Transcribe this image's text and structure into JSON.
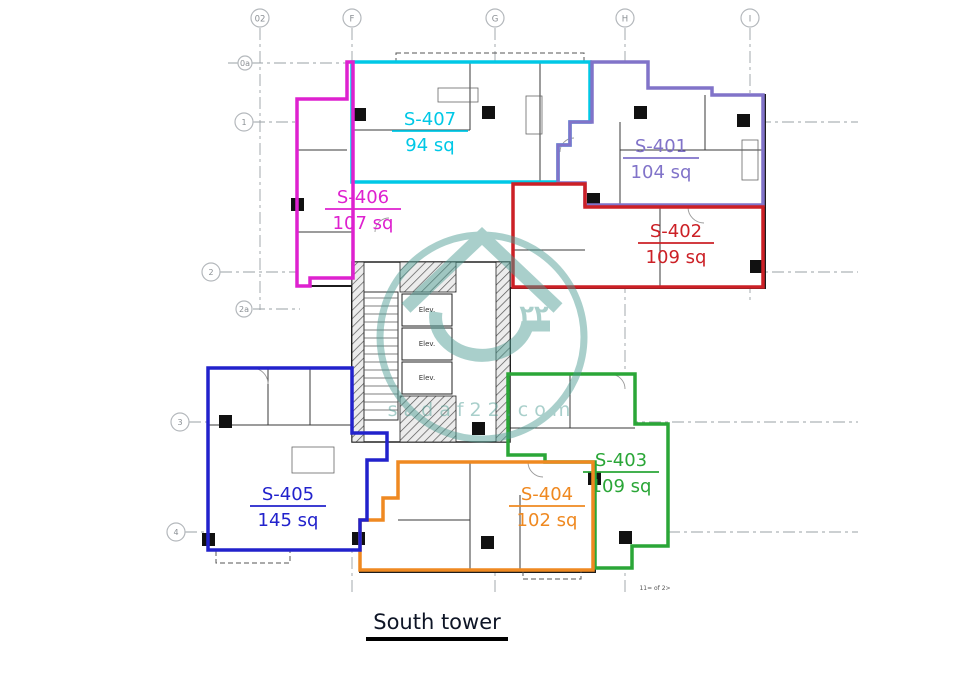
{
  "title": {
    "text": "South tower"
  },
  "footnote": {
    "text": "11= of 2>"
  },
  "watermark": {
    "arabic_number": "٢٢",
    "domain_text": "sadaf22.com",
    "color": "#4d9d93"
  },
  "core": {
    "elevator_label": "Elev."
  },
  "grid": {
    "line_color": "#9aa0a6",
    "bubble_stroke": "#b4b8bc",
    "bubble_text_color": "#8a8f94",
    "top_bubbles": [
      {
        "label": "02",
        "x": 260
      },
      {
        "label": "F",
        "x": 352
      },
      {
        "label": "G",
        "x": 495
      },
      {
        "label": "H",
        "x": 625
      },
      {
        "label": "I",
        "x": 750
      }
    ],
    "left_bubbles": [
      {
        "label": "0a",
        "x": 245,
        "y": 63,
        "r": 7
      },
      {
        "label": "1",
        "x": 244,
        "y": 122,
        "r": 9
      },
      {
        "label": "2",
        "x": 211,
        "y": 272,
        "r": 9
      },
      {
        "label": "2a",
        "x": 244,
        "y": 309,
        "r": 8
      },
      {
        "label": "3",
        "x": 180,
        "y": 422,
        "r": 9
      },
      {
        "label": "4",
        "x": 176,
        "y": 532,
        "r": 9
      }
    ],
    "v_lines": [
      {
        "x": 260,
        "y1": 28,
        "y2": 310
      },
      {
        "x": 352,
        "y1": 28,
        "y2": 595
      },
      {
        "x": 495,
        "y1": 28,
        "y2": 595
      },
      {
        "x": 625,
        "y1": 28,
        "y2": 595
      },
      {
        "x": 750,
        "y1": 28,
        "y2": 300
      }
    ],
    "h_lines": [
      {
        "y": 63,
        "x1": 228,
        "x2": 352
      },
      {
        "y": 122,
        "x1": 253,
        "x2": 858
      },
      {
        "y": 272,
        "x1": 220,
        "x2": 858
      },
      {
        "y": 309,
        "x1": 253,
        "x2": 300
      },
      {
        "y": 422,
        "x1": 189,
        "x2": 858
      },
      {
        "y": 532,
        "x1": 185,
        "x2": 858
      }
    ]
  },
  "units": [
    {
      "id": "s407",
      "name": "S-407",
      "area": "94 sq",
      "color": "#00c8e6",
      "label_x": 430,
      "label_y": 125,
      "points": "352,62 590,62 590,122 570,122 570,145 558,145 558,182 352,182"
    },
    {
      "id": "s406",
      "name": "S-406",
      "area": "107 sq",
      "color": "#de21cf",
      "label_x": 363,
      "label_y": 203,
      "points": "297,99 347,99 347,62 353,62 353,278 310,278 310,286 297,286"
    },
    {
      "id": "s401",
      "name": "S-401",
      "area": "104 sq",
      "color": "#8173c9",
      "label_x": 661,
      "label_y": 152,
      "points": "592,62 648,62 648,88 712,88 712,95 763,95 763,205 585,205 585,183 558,183 558,145 570,145 570,122 592,122"
    },
    {
      "id": "s402",
      "name": "S-402",
      "area": "109 sq",
      "color": "#cc2026",
      "label_x": 676,
      "label_y": 237,
      "points": "513,206 513,184 585,184 585,207 763,207 763,287 513,287"
    },
    {
      "id": "s403",
      "name": "S-403",
      "area": "109 sq",
      "color": "#2aa637",
      "label_x": 621,
      "label_y": 466,
      "points": "508,374 635,374 635,424 668,424 668,546 632,546 632,568 595,568 595,462 545,462 545,455 508,455"
    },
    {
      "id": "s404",
      "name": "S-404",
      "area": "102 sq",
      "color": "#ef8921",
      "label_x": 547,
      "label_y": 500,
      "points": "398,462 593,462 593,570 360,570 360,520 383,520 383,498 398,498"
    },
    {
      "id": "s405",
      "name": "S-405",
      "area": "145 sq",
      "color": "#2222cc",
      "label_x": 288,
      "label_y": 500,
      "points": "208,368 352,368 352,433 387,433 387,460 367,460 367,520 360,520 360,550 208,550"
    }
  ]
}
